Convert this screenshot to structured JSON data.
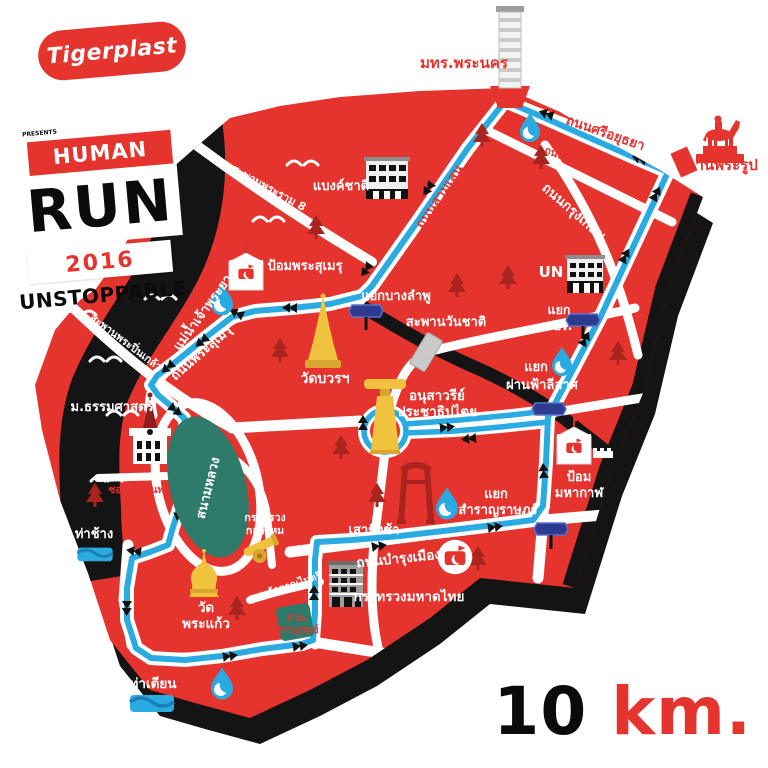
{
  "branding": {
    "logo": "Tigerplast",
    "presents": "PRESENTS",
    "line1": "HUMAN",
    "line2": "RUN",
    "year": "2016",
    "line3": "UNSTOPPABLE"
  },
  "distance": {
    "value": "10",
    "unit": "km."
  },
  "colors": {
    "map_red": "#E5332E",
    "route_blue": "#29ABE2",
    "river_black": "#141414",
    "park_teal": "#2E7A6B",
    "landmark_gold": "#F0C23E",
    "tree_maroon": "#A9241E",
    "sign_navy": "#2D3B8E",
    "white": "#FFFFFF"
  },
  "map": {
    "river": "แม่น้ำเจ้าพระยา",
    "roads": {
      "si_ayutthaya": "ถนนศรีอยุธยา",
      "phitsanulok": "ถนนพิษณุโลก",
      "krung_kasem": "ถนนกรุงเกษม",
      "samsen": "ถนนสามเสน",
      "phra_sumen": "ถนนพระสุเมรุ",
      "bamrung_mueang": "ถนนบำรุงเมือง",
      "kalayanamaitri": "ถนนกัลยาณไมตรี",
      "phra_chan": "ซอยพระจันทร์"
    },
    "bridges": {
      "rama8": "สะพานพระราม 8",
      "pinklao": "สะพานพระปิ่นเกล้า",
      "wanchat": "สะพานวันชาติ"
    },
    "junctions": {
      "banglamphu": "แยกบางลำพู",
      "jpr_line1": "แยก",
      "jpr_line2": "จปร.",
      "phanfa_line1": "แยก",
      "phanfa_line2": "ผ่านฟ้าลีลาศ",
      "samranrat_line1": "แยก",
      "samranrat_line2": "สำราญราษฎร์"
    },
    "landmarks": {
      "rmutp": "มทร.พระนคร",
      "royal_plaza": "ลานพระรูป",
      "bank_of_thailand": "แบงค์ชาติ",
      "un": "UN",
      "phra_sumen_fort": "ป้อมพระสุเมรุ",
      "mahakan_fort_line1": "ป้อม",
      "mahakan_fort_line2": "มหากาฬ",
      "wat_bowon": "วัดบวรฯ",
      "thammasat": "ม.ธรรมศาสตร์",
      "democracy_line1": "อนุสาวรีย์",
      "democracy_line2": "ประชาธิปไตย",
      "giant_swing": "เสาชิงช้า",
      "sanam_luang": "สนามหลวง",
      "tha_chang": "ท่าช้าง",
      "defence_line1": "กระทรวง",
      "defence_line2": "กลาโหม",
      "wat_phra_kaew_line1": "วัด",
      "wat_phra_kaew_line2": "พระแก้ว",
      "saranrom_line1": "สวน",
      "saranrom_line2": "สราญรมย์",
      "interior_ministry": "กระทรวงมหาดไทย",
      "tha_tien": "ท่าเตียน"
    },
    "icons": {
      "water_station": "water-drop-icon",
      "photo_spot": "camera-badge-icon",
      "junction_sign": "navy-road-sign-icon",
      "tree": "pine-tree-icon",
      "pier": "waves-icon"
    }
  }
}
